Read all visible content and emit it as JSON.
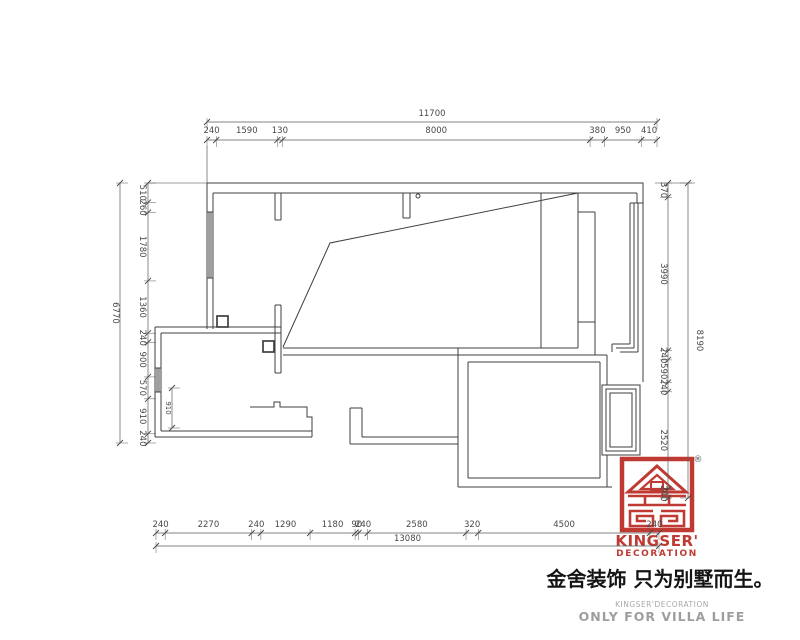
{
  "drawing": {
    "dimension_chains": {
      "top": {
        "total": "11700",
        "segments": [
          "240",
          "1590",
          "130",
          "8000",
          "380",
          "950",
          "410"
        ]
      },
      "bottom": {
        "total": "13080",
        "segments": [
          "240",
          "2270",
          "240",
          "1290",
          "1180",
          "90",
          "240",
          "2580",
          "320",
          "4500",
          "240"
        ]
      },
      "left": {
        "total": "6770",
        "segments": [
          "510",
          "260",
          "1780",
          "1360",
          "240",
          "900",
          "570",
          "910",
          "240"
        ]
      },
      "right": {
        "total": "8190",
        "segments": [
          "370",
          "3990",
          "240",
          "590",
          "240",
          "2520",
          "240"
        ]
      },
      "interior": {
        "segments": [
          "910"
        ]
      }
    }
  },
  "logo": {
    "registered_mark": "®",
    "brand_line1": "KINGSER'",
    "brand_line2": "DECORATION"
  },
  "footer": {
    "tagline_cn": "金舍装饰 只为别墅而生。",
    "brand_small": "KINGSER'DECORATION",
    "slogan_en": "ONLY FOR VILLA LIFE"
  },
  "colors": {
    "brand_red": "#bf3a33",
    "wall_line": "#3f3f3f",
    "dim_line": "#5a5a5a",
    "dim_text": "#484848",
    "footer_gray": "#9e9e9e"
  }
}
